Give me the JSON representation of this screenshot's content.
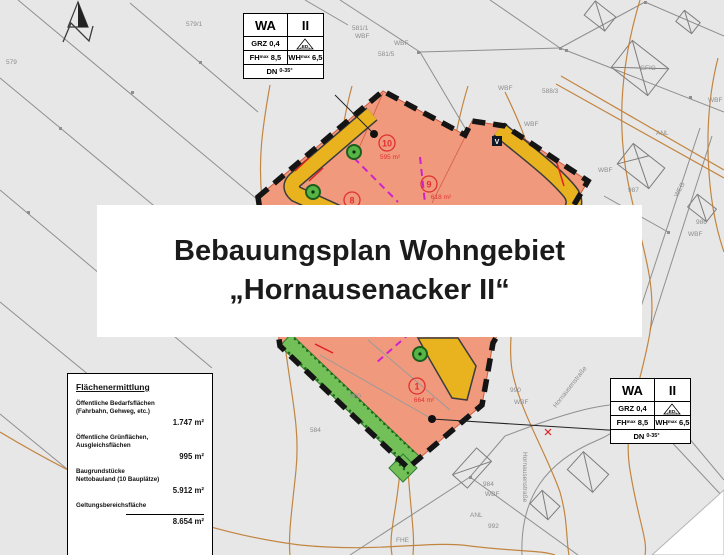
{
  "title_overlay": {
    "line1": "Bebauungsplan Wohngebiet",
    "line2": "„Hornausenacker II“"
  },
  "legend": {
    "use": "WA",
    "storeys": "II",
    "grz": "GRZ 0,4",
    "roof_icon": "ED",
    "fh": "FH",
    "fh_val": "8,5",
    "wh": "WH",
    "wh_val": "6,5",
    "sub": "max",
    "dn": "DN",
    "dn_val": "0-35°"
  },
  "flaechenermittlung": {
    "title": "Flächenermittlung",
    "items": [
      {
        "label": "Öffentliche Bedarfsflächen",
        "label2": "(Fahrbahn, Gehweg, etc.)",
        "value": "1.747 m²"
      },
      {
        "label": "Öffentliche Grünflächen,",
        "label2": "Ausgleichsflächen",
        "value": "995 m²"
      },
      {
        "label": "Baugrundstücke",
        "label2": "Nettobauland (10 Bauplätze)",
        "value": "5.912 m²"
      },
      {
        "label": "Geltungsbereichsfläche",
        "label2": "",
        "value": "8.654 m²"
      }
    ]
  },
  "map": {
    "v_marker": "V",
    "north_icon": "north-arrow",
    "plots": [
      {
        "no": "10",
        "area": "595 m²"
      },
      {
        "no": "9",
        "area": "618 m²"
      },
      {
        "no": "8",
        "area": ""
      },
      {
        "no": "1",
        "area": "664 m²"
      }
    ],
    "labels": [
      "579",
      "579/1",
      "581/1",
      "WBF",
      "WBF",
      "581/5",
      "WBF",
      "588/3",
      "WBF",
      "WBF",
      "GFIG",
      "WBF",
      "ANL",
      "987",
      "WEG",
      "986",
      "WBF",
      "584",
      "590",
      "990",
      "WBF",
      "Hornausenstraße",
      "Hornausenstraße",
      "984",
      "WBF",
      "ANL",
      "992",
      "FHE"
    ],
    "colors": {
      "plan_area": "#f0997d",
      "road": "#e9b320",
      "green_area": "#74c058",
      "boundary": "#141414",
      "parcel_divider": "#cc22cc",
      "contour": "#bf7b2f"
    }
  }
}
